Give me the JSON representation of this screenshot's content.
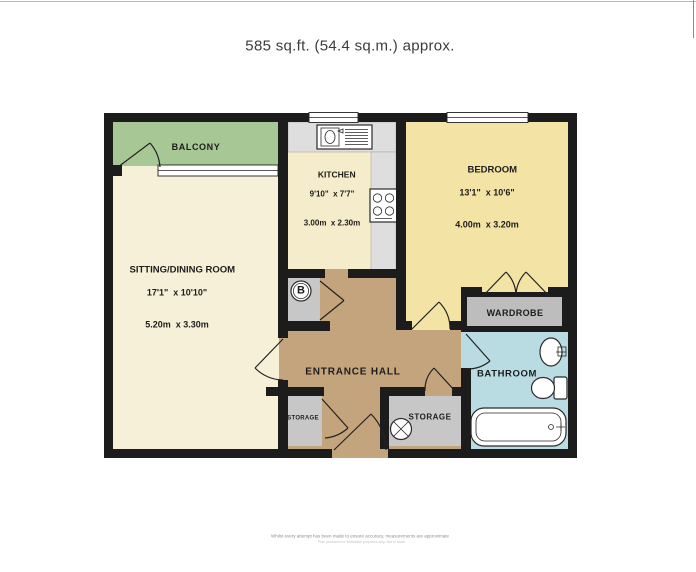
{
  "title": "585 sq.ft. (54.4 sq.m.) approx.",
  "rooms": {
    "balcony": {
      "name": "BALCONY"
    },
    "sitting_dining": {
      "name": "SITTING/DINING ROOM",
      "size_imperial": "17'1\"  x 10'10\"",
      "size_metric": "5.20m  x 3.30m"
    },
    "kitchen": {
      "name": "KITCHEN",
      "size_imperial": "9'10\"  x 7'7\"",
      "size_metric": "3.00m  x 2.30m"
    },
    "bedroom": {
      "name": "BEDROOM",
      "size_imperial": "13'1\"  x 10'6\"",
      "size_metric": "4.00m  x 3.20m"
    },
    "entrance_hall": {
      "name": "ENTRANCE HALL"
    },
    "wardrobe": {
      "name": "WARDROBE"
    },
    "bathroom": {
      "name": "BATHROOM"
    },
    "storage_small": {
      "name": "STORAGE"
    },
    "storage_large": {
      "name": "STORAGE"
    }
  },
  "symbols": {
    "boiler": "B"
  },
  "colors": {
    "wall": "#1c1c1c",
    "balcony": "#a7c795",
    "sitting": "#f7f0d8",
    "kitchen": "#f5eccb",
    "bedroom": "#f3e4a5",
    "hall": "#c3a47d",
    "bathroom": "#b9dce3",
    "storage": "#c7c7c7",
    "wardrobe": "#bdbdbd",
    "counter": "#dedede"
  },
  "footer": {
    "line1": "Whilst every attempt has been made to ensure accuracy, measurements are approximate",
    "line2": "Plan produced for illustrative purposes only. Not to scale."
  }
}
